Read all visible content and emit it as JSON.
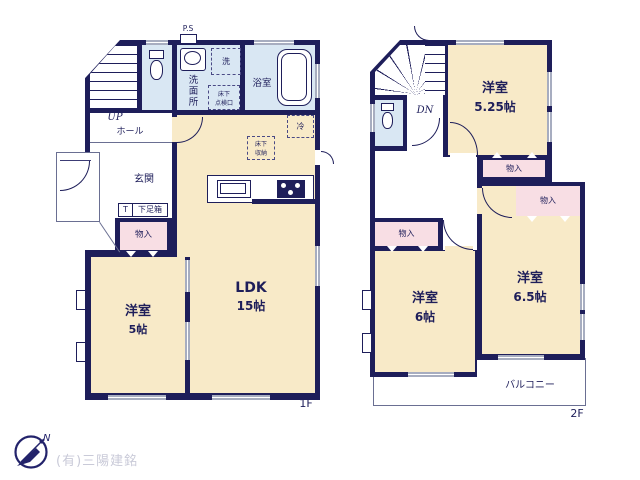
{
  "colors": {
    "wall": "#1e1e5a",
    "room_fill": "#f8eac8",
    "wet_fill": "#d9e7f3",
    "closet_fill": "#f8dee4",
    "window": "#a7adc0",
    "outline": "#6a6f92",
    "company_text": "#c9cad8"
  },
  "floor1": {
    "label": "1F",
    "ps": "P.S",
    "up": "UP",
    "hall": "ホール",
    "entrance": "玄関",
    "t": "T",
    "shoe_box": "下足箱",
    "closet": "物入",
    "washroom": "洗面所",
    "washer": "洗",
    "underfloor_hatch": "床下\n点検口",
    "bath": "浴室",
    "fridge": "冷",
    "underfloor_storage": "床下\n収納",
    "ldk_name": "LDK",
    "ldk_size": "15帖",
    "room5_name": "洋室",
    "room5_size": "5帖"
  },
  "floor2": {
    "label": "2F",
    "dn": "DN",
    "closet": "物入",
    "balcony": "バルコニー",
    "room525_name": "洋室",
    "room525_size": "5.25帖",
    "room65_name": "洋室",
    "room65_size": "6.5帖",
    "room6_name": "洋室",
    "room6_size": "6帖"
  },
  "footer": {
    "company": "(有)三陽建銘",
    "compass_n": "N"
  }
}
